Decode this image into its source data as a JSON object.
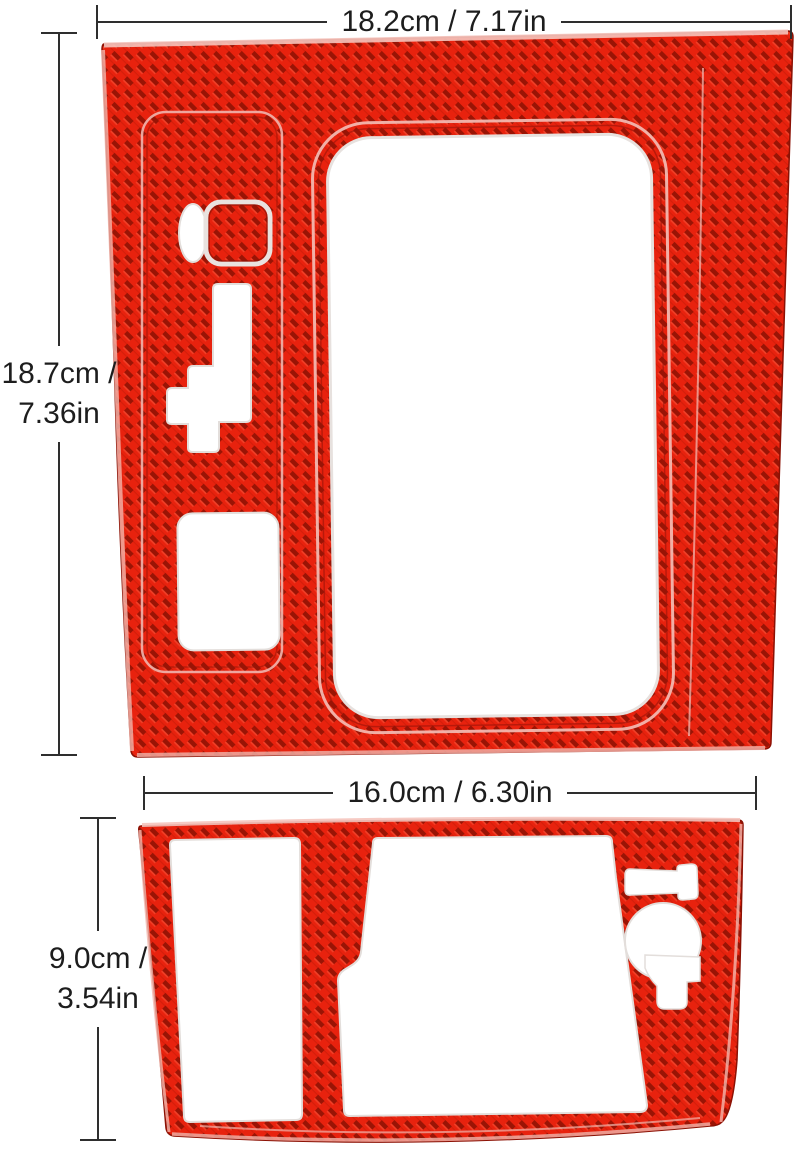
{
  "dimensions": {
    "top_panel_width": "18.2cm / 7.17in",
    "top_panel_height_line1": "18.7cm /",
    "top_panel_height_line2": "7.36in",
    "bottom_panel_width": "16.0cm / 6.30in",
    "bottom_panel_height_line1": "9.0cm /",
    "bottom_panel_height_line2": "3.54in"
  },
  "colors": {
    "carbon_red_bright": "#e8220e",
    "carbon_red_dark": "#9a1405",
    "carbon_edge_highlight": "#f5c4bc",
    "dimension_line": "#2e2e2e",
    "background": "#ffffff"
  },
  "icons": {
    "top_panel": "carbon-fiber-gear-shift-panel",
    "bottom_panel": "carbon-fiber-console-panel"
  }
}
